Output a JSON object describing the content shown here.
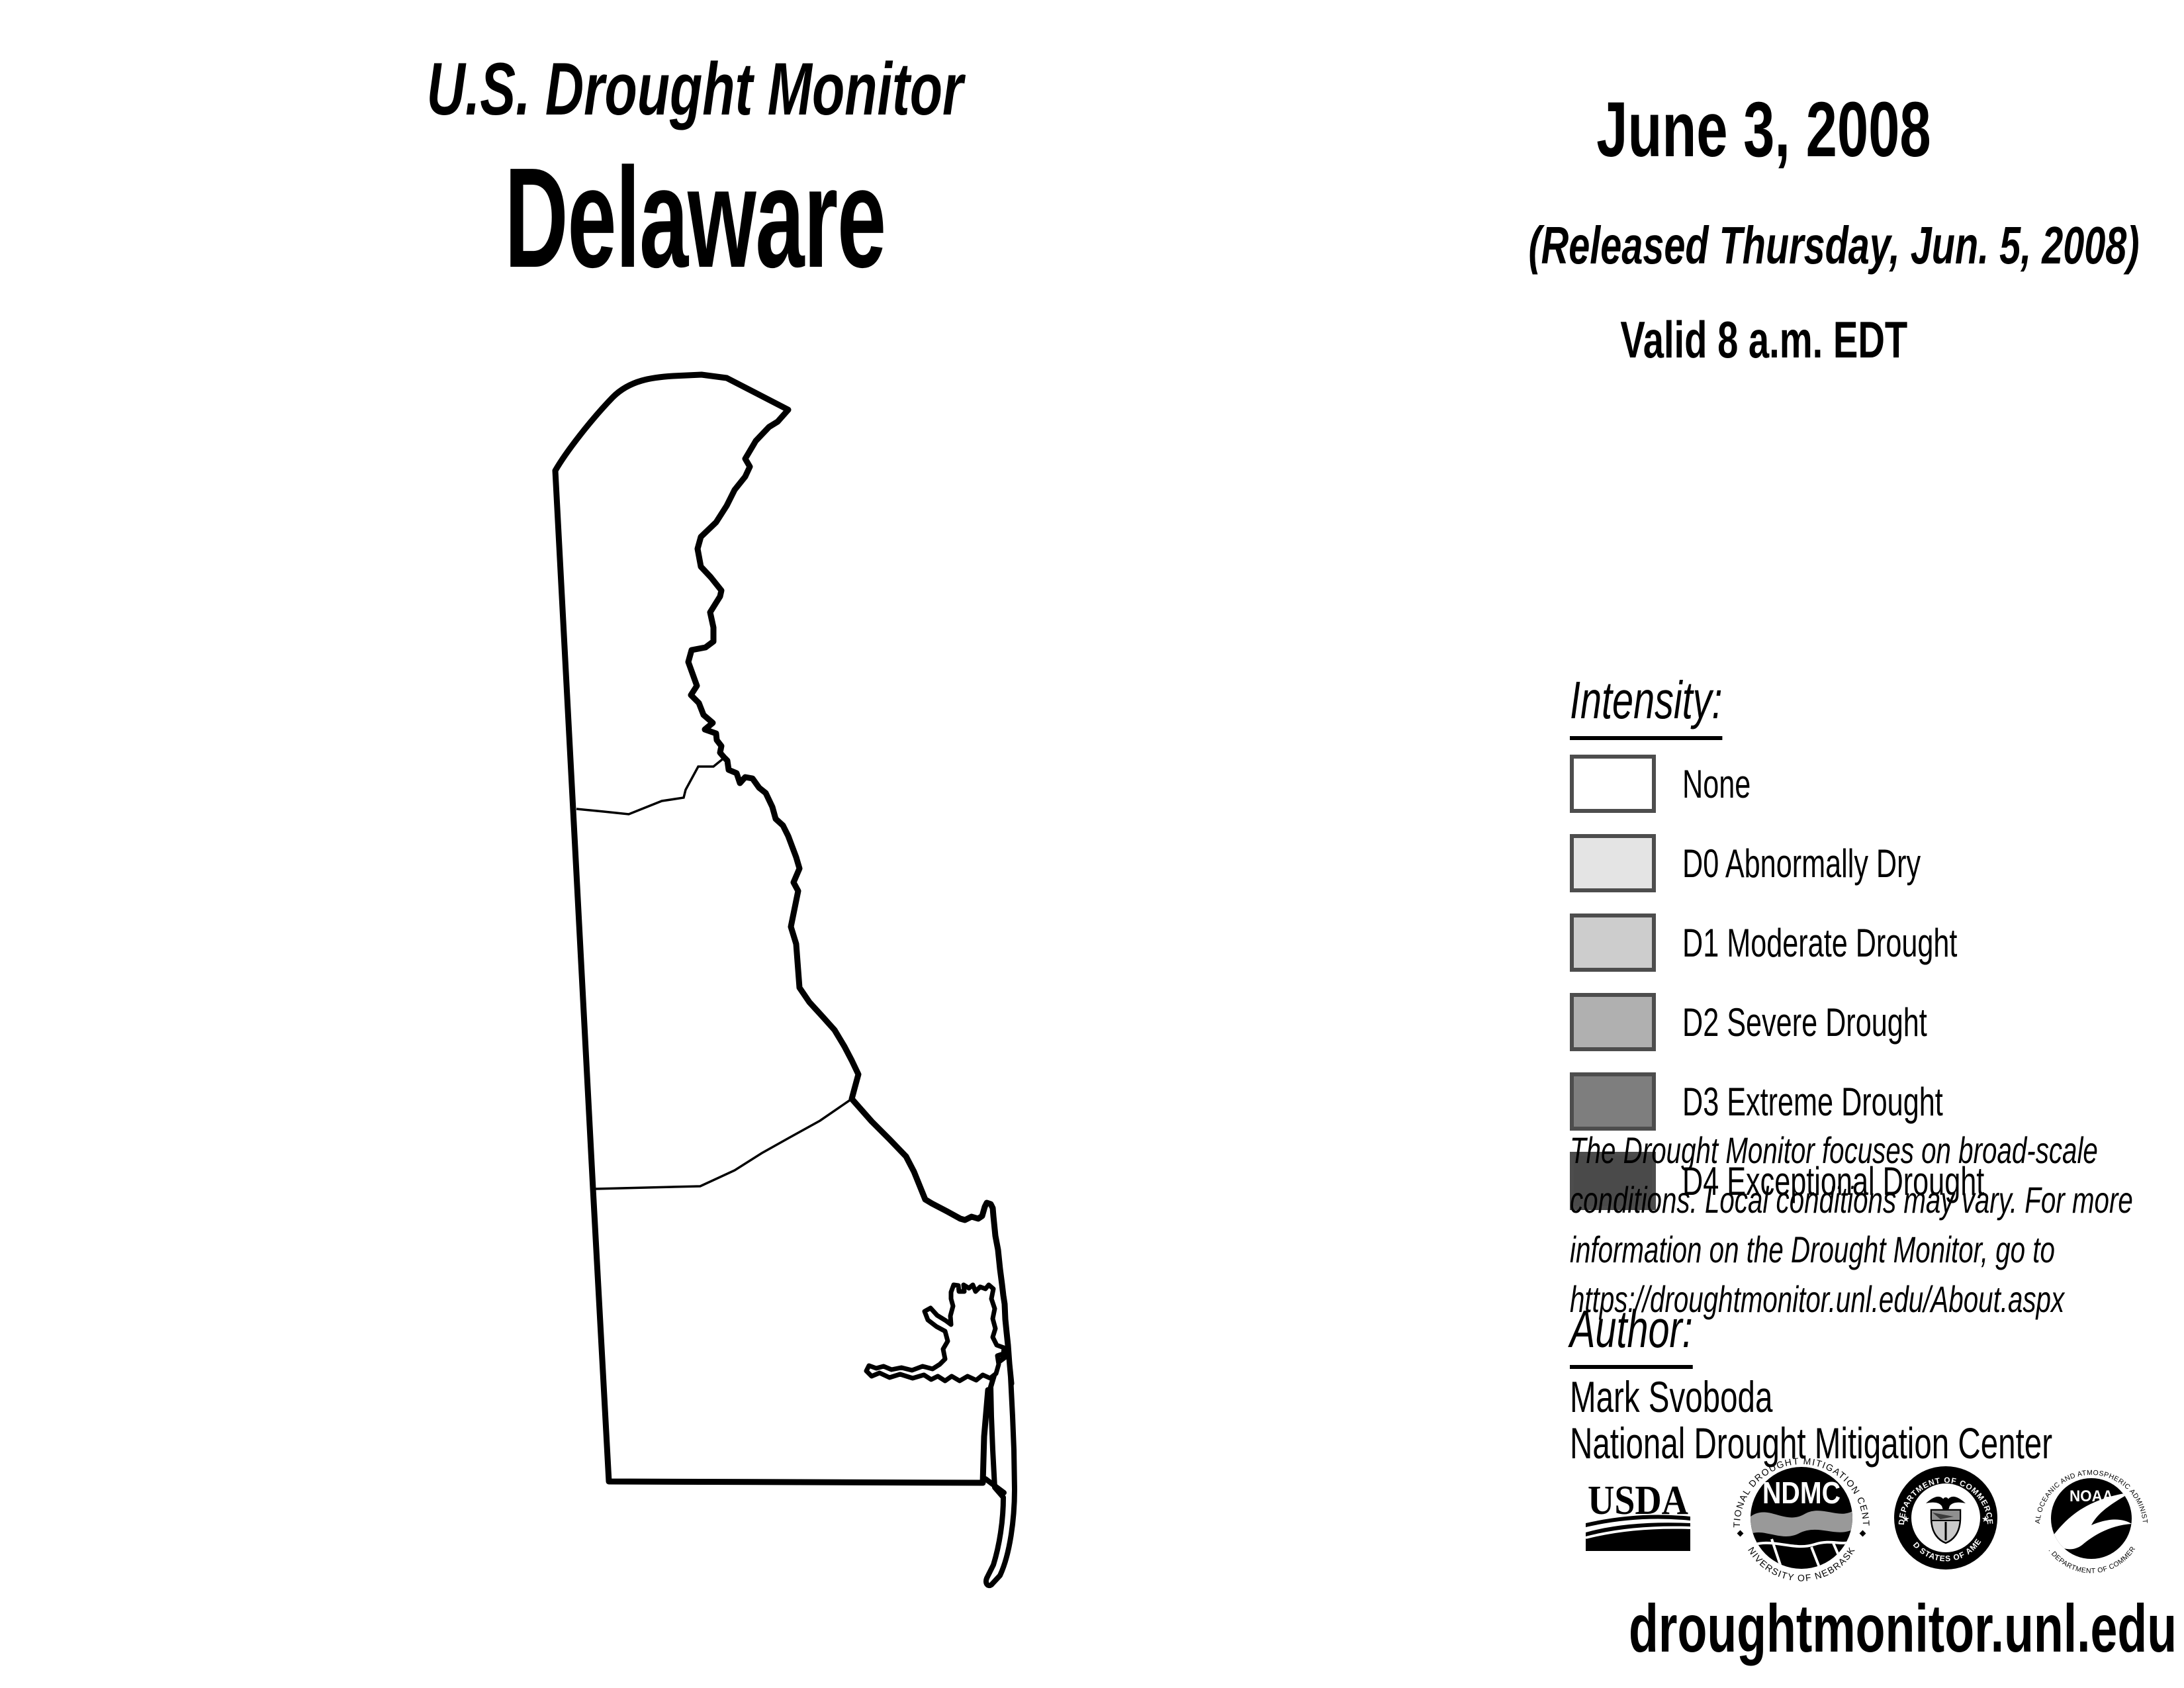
{
  "header": {
    "title": "U.S. Drought Monitor",
    "region": "Delaware"
  },
  "date_block": {
    "map_date": "June 3, 2008",
    "released": "(Released Thursday, Jun. 5, 2008)",
    "valid": "Valid 8 a.m. EDT"
  },
  "legend": {
    "heading": "Intensity:",
    "swatch_border_color": "#4d4d4d",
    "items": [
      {
        "label": "None",
        "color": "#ffffff"
      },
      {
        "label": "D0 Abnormally Dry",
        "color": "#e4e4e4"
      },
      {
        "label": "D1 Moderate Drought",
        "color": "#cdcdcd"
      },
      {
        "label": "D2 Severe Drought",
        "color": "#b0b0b0"
      },
      {
        "label": "D3 Extreme Drought",
        "color": "#7e7e7e"
      },
      {
        "label": "D4 Exceptional Drought",
        "color": "#4a4a4a"
      }
    ]
  },
  "disclaimer": {
    "lines": [
      "The Drought Monitor focuses on broad-scale",
      "conditions. Local conditions may vary. For more",
      "information on the Drought Monitor, go to",
      "https://droughtmonitor.unl.edu/About.aspx"
    ]
  },
  "author_block": {
    "heading": "Author:",
    "name": "Mark Svoboda",
    "organization": "National Drought Mitigation Center"
  },
  "footer": {
    "url": "droughtmonitor.unl.edu"
  },
  "logos": {
    "usda": {
      "text": "USDA"
    },
    "ndmc": {
      "text": "NDMC",
      "ring_top": "NATIONAL DROUGHT MITIGATION CENTER",
      "ring_bottom": "UNIVERSITY OF NEBRASKA"
    },
    "commerce": {
      "ring_top": "DEPARTMENT OF COMMERCE",
      "ring_bottom": "UNITED STATES OF AMERICA"
    },
    "noaa": {
      "text": "NOAA",
      "ring_top": "NATIONAL OCEANIC AND ATMOSPHERIC ADMINISTRATION",
      "ring_bottom": "U.S. DEPARTMENT OF COMMERCE"
    }
  },
  "map": {
    "region": "Delaware",
    "outline_color": "#000000"
  }
}
